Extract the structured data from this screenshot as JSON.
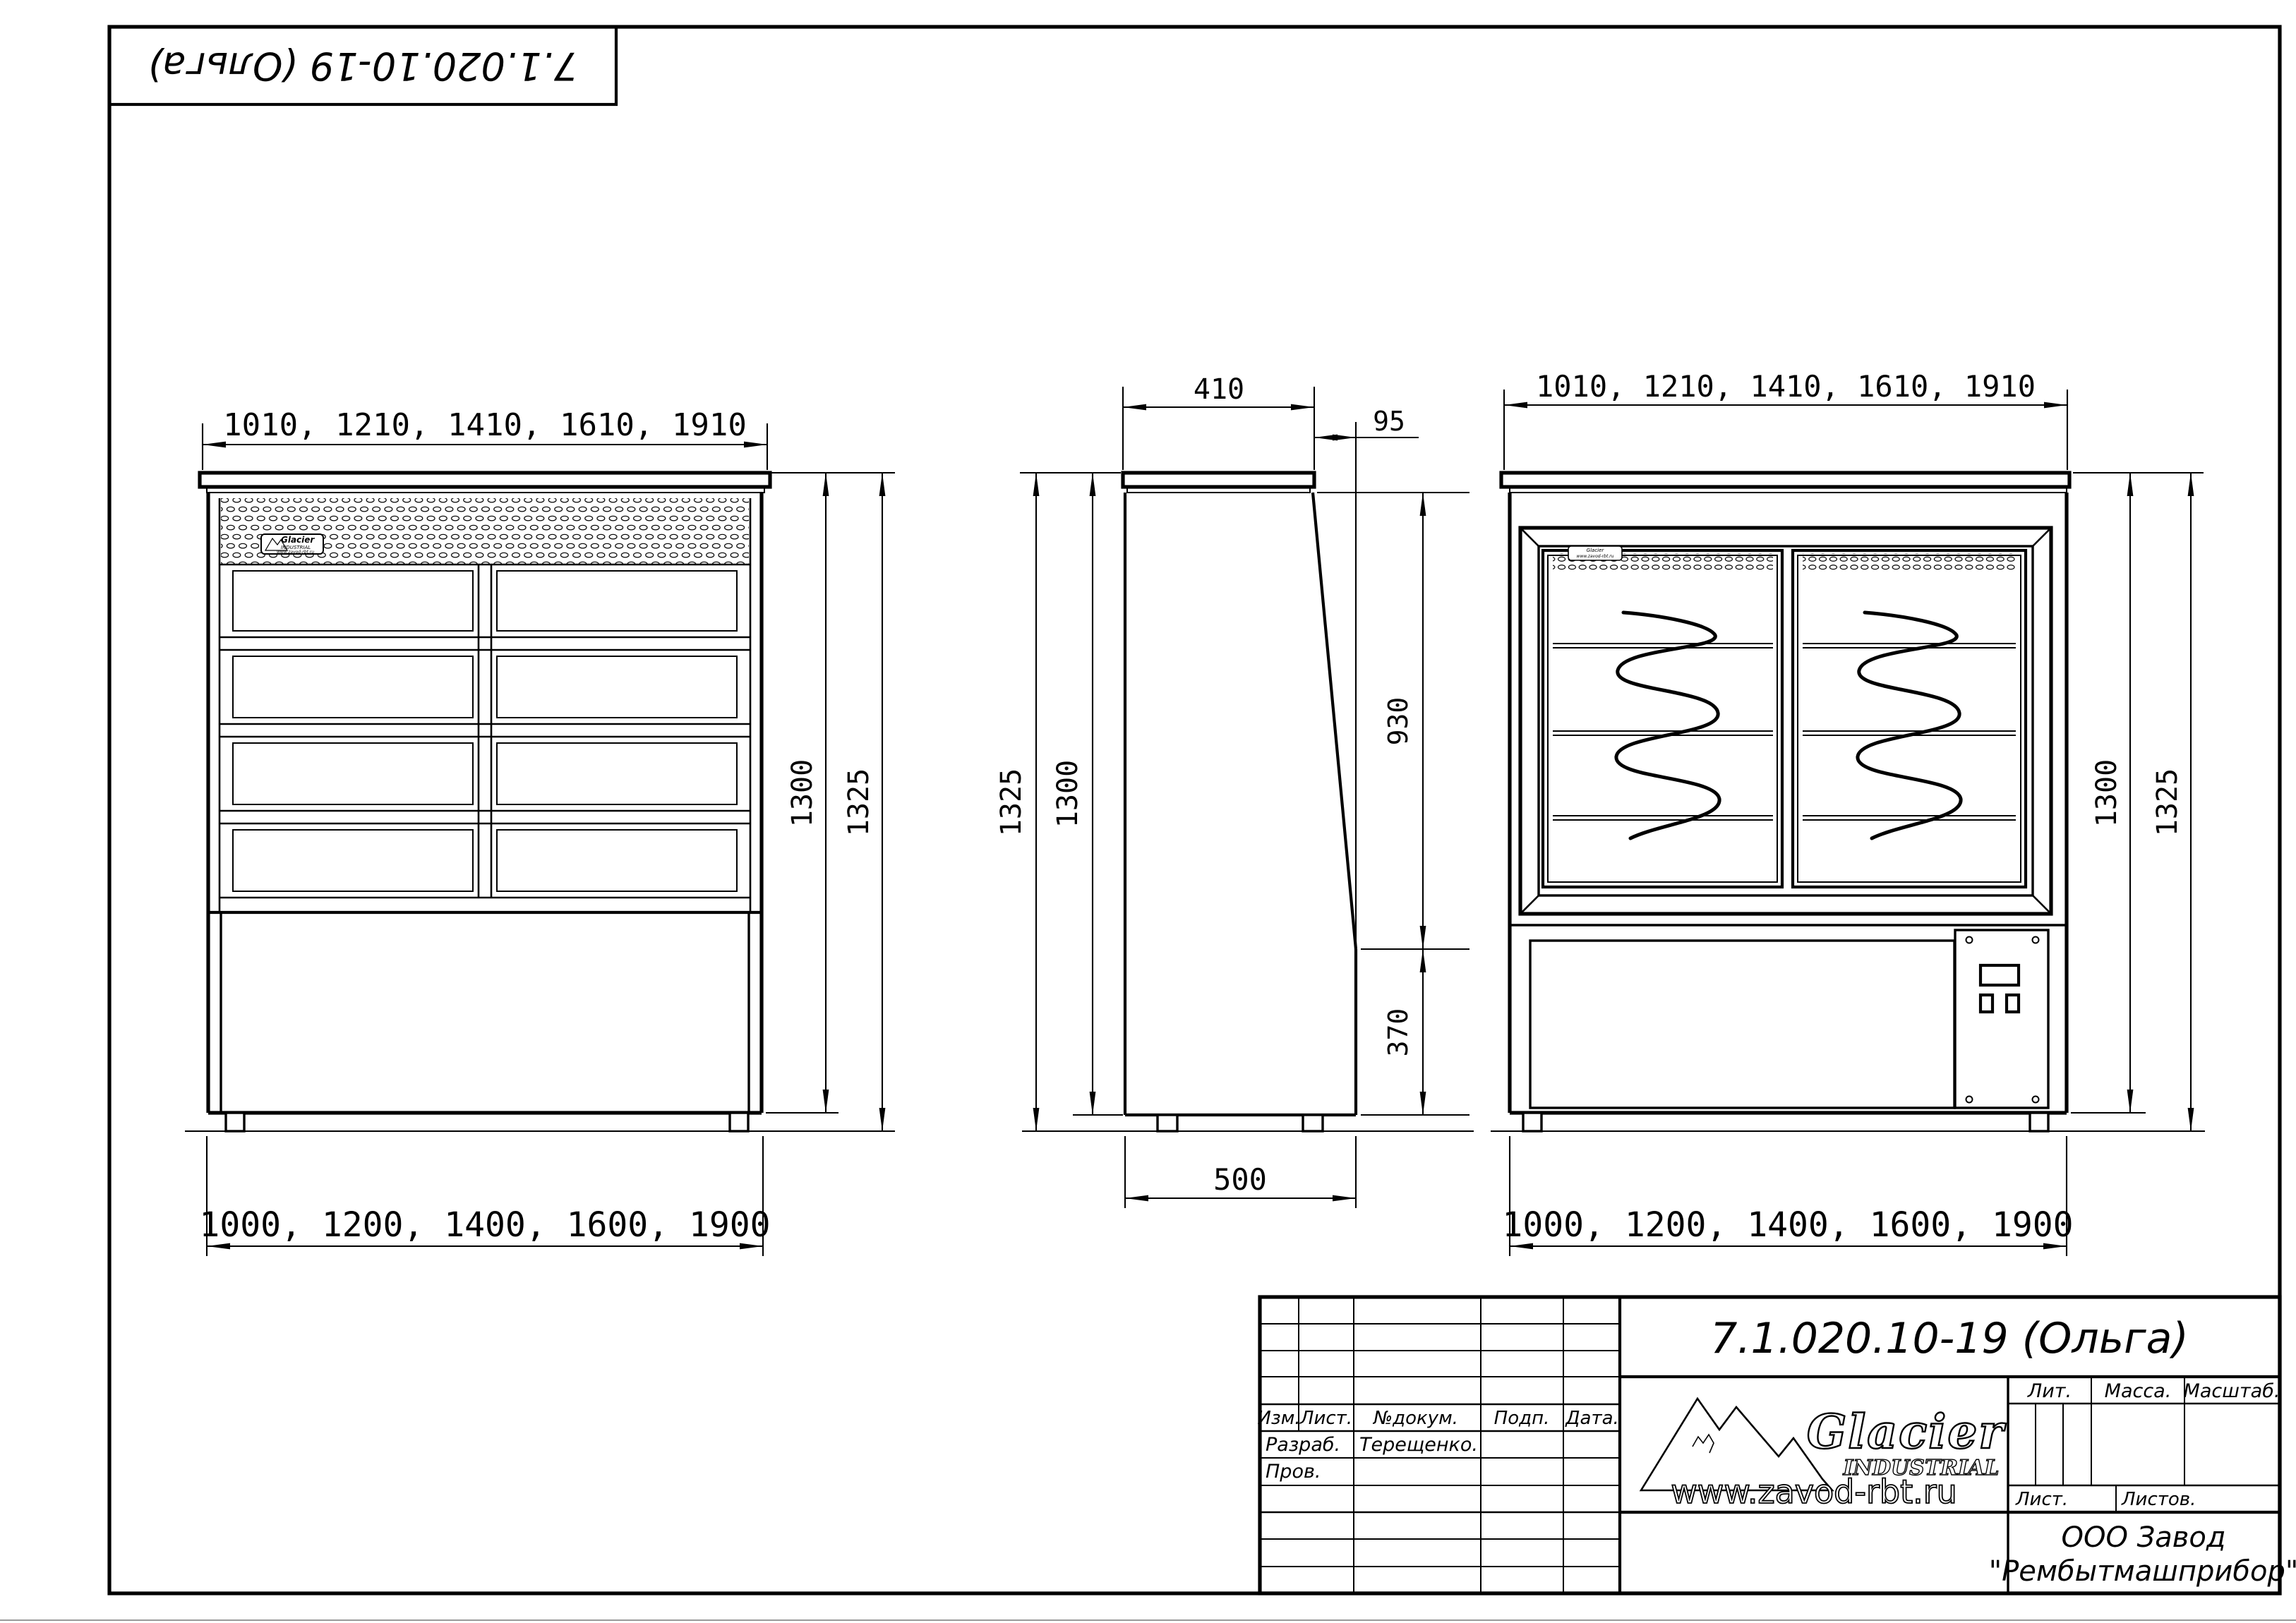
{
  "doc": {
    "code": "7.1.020.10-19 (Ольга)"
  },
  "dims": {
    "front": {
      "top": "1010, 1210, 1410, 1610, 1910",
      "bottom": "1000, 1200, 1400, 1600, 1900",
      "h_inner": "1300",
      "h_outer": "1325"
    },
    "side": {
      "depth_top": "410",
      "offset": "95",
      "h_upper": "930",
      "h_lower": "370",
      "depth_bottom": "500",
      "h_inner": "1300",
      "h_outer": "1325"
    },
    "rear": {
      "top": "1010, 1210, 1410, 1610, 1910",
      "bottom": "1000, 1200, 1400, 1600, 1900",
      "h_inner": "1300",
      "h_outer": "1325"
    }
  },
  "title_block": {
    "designation": "7.1.020.10-19 (Ольга)",
    "header": {
      "izm": "Изм.",
      "list": "Лист.",
      "docnum": "№докум.",
      "podp": "Подп.",
      "data": "Дата."
    },
    "signatures": {
      "razrab_label": "Разраб.",
      "razrab_name": "Терещенко.",
      "prov_label": "Пров."
    },
    "props": {
      "lit": "Лит.",
      "massa": "Масса.",
      "masshtab": "Масштаб.",
      "list": "Лист.",
      "listov": "Листов."
    },
    "company": {
      "line1": "ООО Завод",
      "line2": "\"Рембытмашприбор\""
    },
    "logo": {
      "name": "Glacier",
      "sub": "INDUSTRIAL",
      "site": "www.zavod-rbt.ru"
    }
  }
}
